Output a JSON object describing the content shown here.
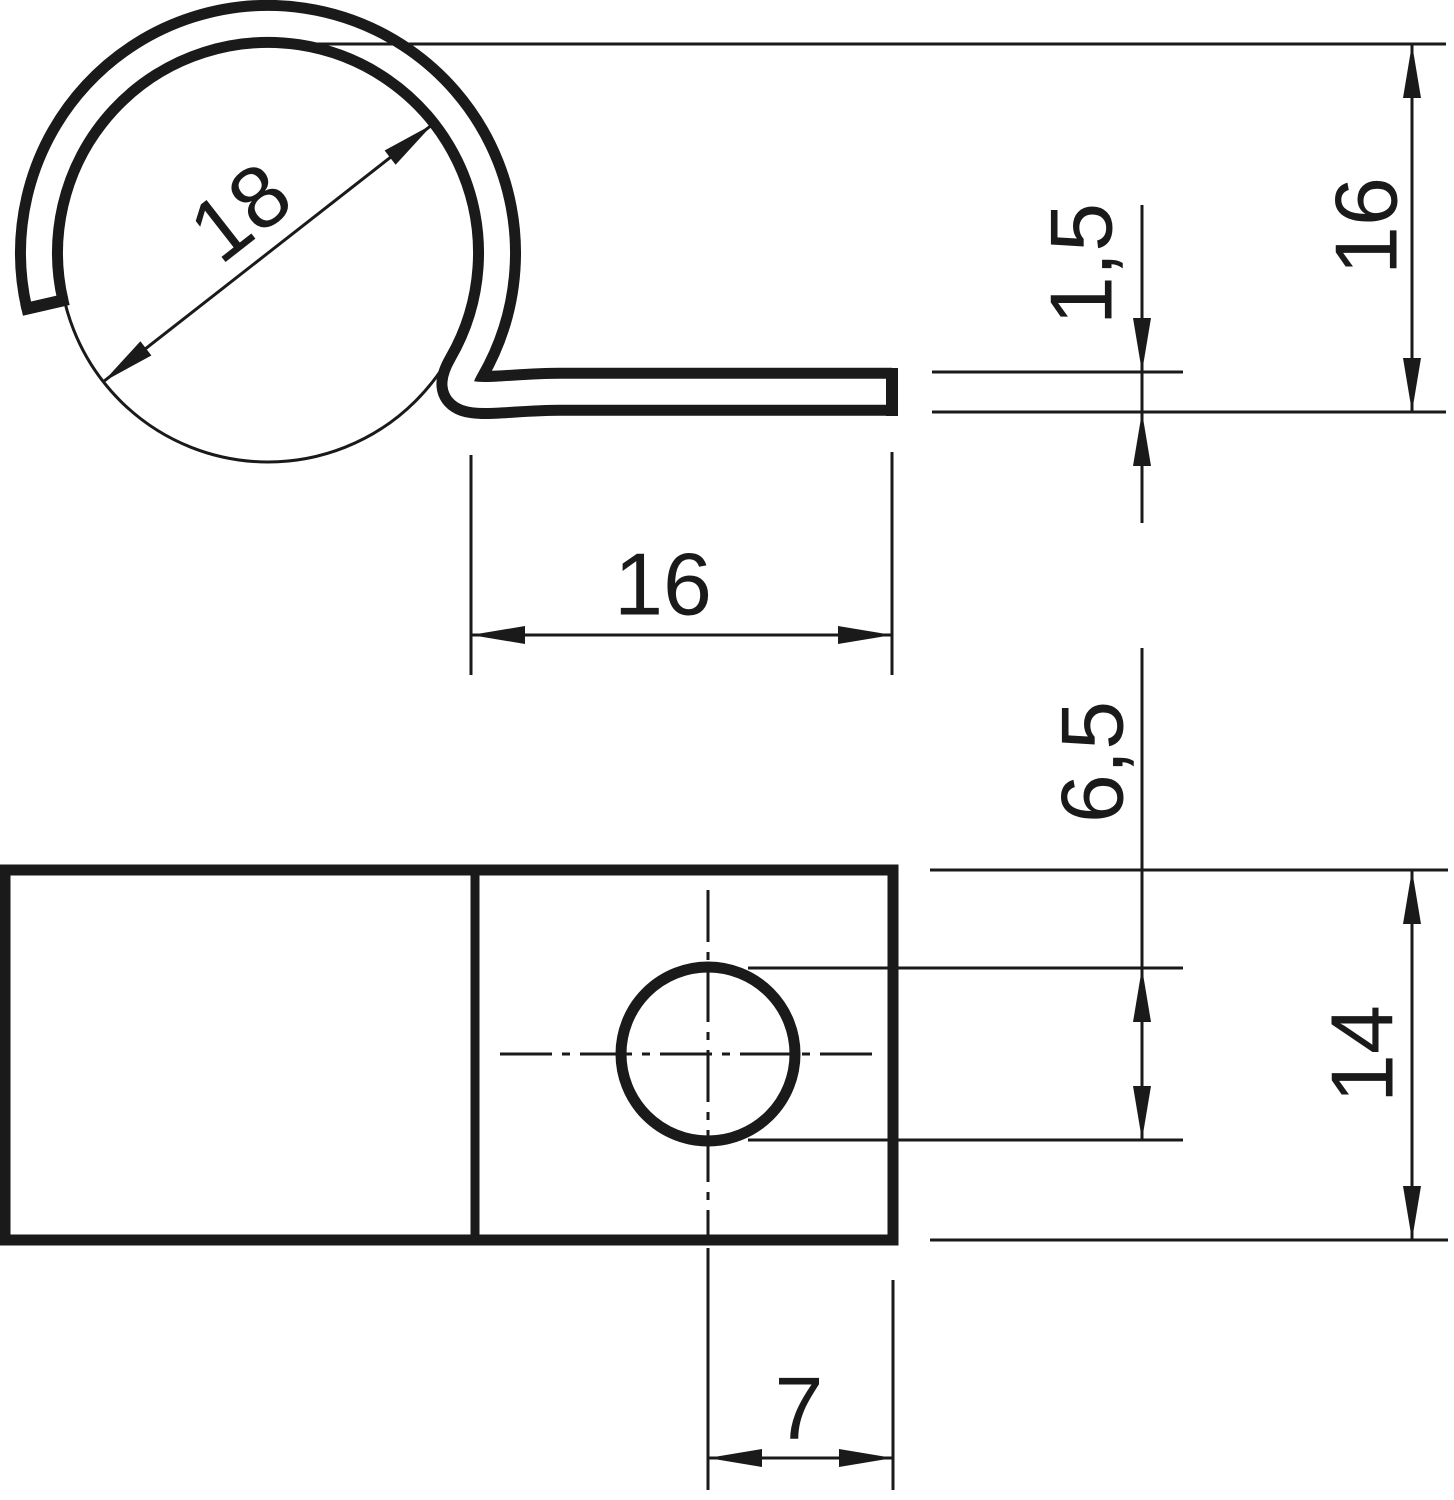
{
  "drawing": {
    "labels": {
      "cable_diameter": "18",
      "flat_leg_length": "16",
      "material_thickness": "1,5",
      "clip_height": "16",
      "hole_height": "6,5",
      "plate_width": "14",
      "hole_center_to_edge": "7"
    },
    "colors": {
      "line": "#1a1a1a",
      "background": "#ffffff"
    }
  }
}
